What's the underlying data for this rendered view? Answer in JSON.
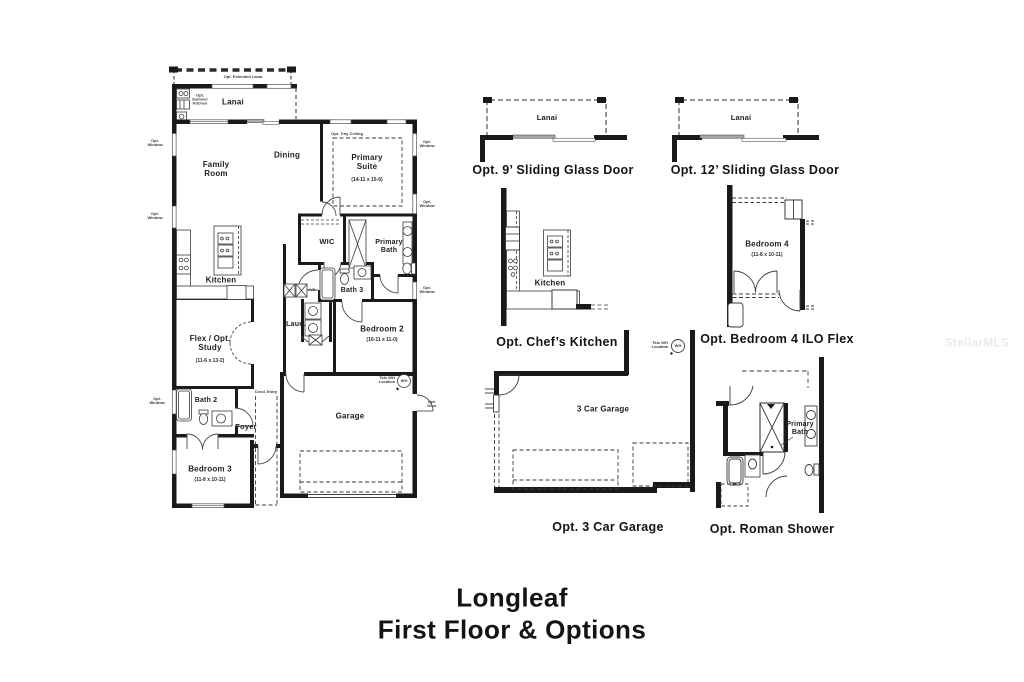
{
  "title": {
    "line1": "Longleaf",
    "line2": "First Floor & Options"
  },
  "watermark": "StellarMLS",
  "rooms": {
    "extended_lanai": "Opt. Extended Lanai",
    "lanai": "Lanai",
    "summer_kitchen": "Opt. Summer Kitchen",
    "family_room": "Family Room",
    "dining": "Dining",
    "primary_suite": "Primary Suite",
    "primary_suite_dims": "(14-11 x 15-6)",
    "tray_ceiling": "Opt. Tray Ceiling",
    "kitchen": "Kitchen",
    "wic": "WIC",
    "primary_bath": "Primary Bath",
    "bath3": "Bath 3",
    "laundry": "Laun.",
    "ac": "A/C",
    "bedroom2": "Bedroom 2",
    "bedroom2_dims": "(10-11 x 11-0)",
    "flex_study": "Flex / Opt. Study",
    "flex_study_dims": "(11-6 x 13-2)",
    "bath2": "Bath 2",
    "foyer": "Foyer",
    "covd_entry": "Covd. Entry",
    "garage": "Garage",
    "bedroom3": "Bedroom 3",
    "bedroom3_dims": "(11-8 x 10-11)",
    "opt_window": "Opt. Window",
    "opt_door": "Opt. Door",
    "wh": "WH",
    "wh_location": "Tkls WH Location"
  },
  "options": {
    "slider9": {
      "caption": "Opt. 9’ Sliding Glass Door",
      "room": "Lanai"
    },
    "slider12": {
      "caption": "Opt. 12’ Sliding Glass Door",
      "room": "Lanai"
    },
    "chefs_kitchen": {
      "caption": "Opt. Chef’s Kitchen",
      "room": "Kitchen"
    },
    "bedroom4": {
      "caption": "Opt. Bedroom 4 ILO Flex",
      "room": "Bedroom 4",
      "dims": "(11-8 x 10-11)"
    },
    "garage3": {
      "caption": "Opt. 3 Car Garage",
      "room": "3 Car Garage",
      "wh": "WH",
      "wh_location": "Tkls WH Location"
    },
    "roman_shower": {
      "caption": "Opt. Roman Shower",
      "room": "Primary Bath"
    }
  }
}
